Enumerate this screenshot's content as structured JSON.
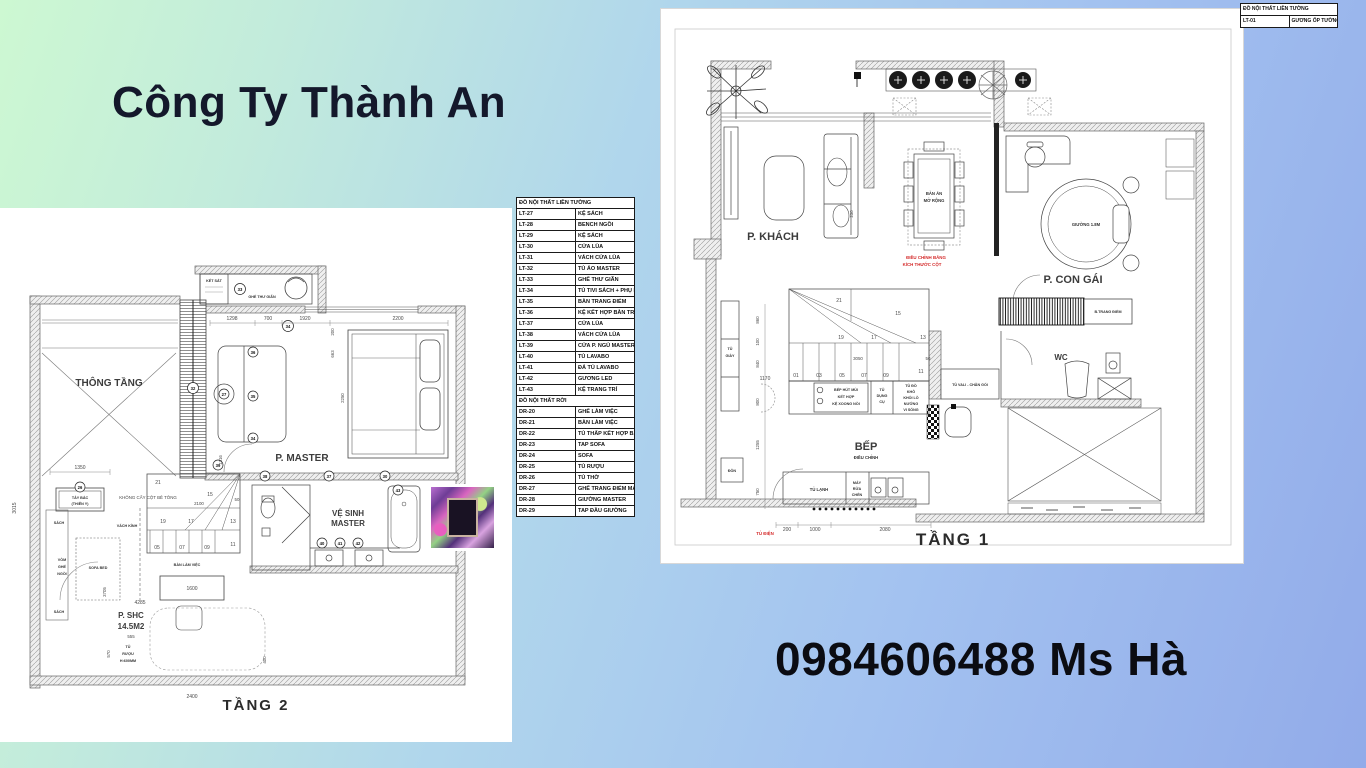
{
  "header": {
    "company": "Công Ty Thành An"
  },
  "footer": {
    "phone": "0984606488 Ms Hà"
  },
  "legend_top": {
    "header": "ĐỒ NỘI THẤT LIỀN TƯỜNG",
    "item": {
      "code": "LT-01",
      "label": "GƯƠNG ỐP TƯỜNG"
    }
  },
  "legend_main": {
    "section1_header": "ĐỒ NỘI THẤT LIỀN TƯỜNG",
    "items1": [
      {
        "code": "LT-27",
        "label": "KỆ SÁCH"
      },
      {
        "code": "LT-28",
        "label": "BENCH NGỒI"
      },
      {
        "code": "LT-29",
        "label": "KỆ SÁCH"
      },
      {
        "code": "LT-30",
        "label": "CỬA LÙA"
      },
      {
        "code": "LT-31",
        "label": "VÁCH CỬA LÙA"
      },
      {
        "code": "LT-32",
        "label": "TỦ ÁO MASTER"
      },
      {
        "code": "LT-33",
        "label": "GHẾ THƯ GIÃN"
      },
      {
        "code": "LT-34",
        "label": "TỦ TIVI SÁCH + PHỤ KIỆN"
      },
      {
        "code": "LT-35",
        "label": "BÀN TRANG ĐIỂM"
      },
      {
        "code": "LT-36",
        "label": "KỆ KẾT HỢP BÀN TRANG ĐIỂM"
      },
      {
        "code": "LT-37",
        "label": "CỬA LÙA"
      },
      {
        "code": "LT-38",
        "label": "VÁCH CỬA LÙA"
      },
      {
        "code": "LT-39",
        "label": "CỬA P. NGỦ MASTER"
      },
      {
        "code": "LT-40",
        "label": "TỦ LAVABO"
      },
      {
        "code": "LT-41",
        "label": "ĐÁ TỦ LAVABO"
      },
      {
        "code": "LT-42",
        "label": "GƯƠNG LED"
      },
      {
        "code": "LT-43",
        "label": "KỆ TRANG TRÍ"
      }
    ],
    "section2_header": "ĐỒ NỘI THẤT RỜI",
    "items2": [
      {
        "code": "DR-20",
        "label": "GHẾ LÀM VIỆC"
      },
      {
        "code": "DR-21",
        "label": "BÀN LÀM VIỆC"
      },
      {
        "code": "DR-22",
        "label": "TỦ THẤP KẾT HỢP BÀN LÀM VIỆC"
      },
      {
        "code": "DR-23",
        "label": "TAP SOFA"
      },
      {
        "code": "DR-24",
        "label": "SOFA"
      },
      {
        "code": "DR-25",
        "label": "TỦ RƯỢU"
      },
      {
        "code": "DR-26",
        "label": "TỦ THỜ"
      },
      {
        "code": "DR-27",
        "label": "GHẾ TRANG ĐIỂM MASTER"
      },
      {
        "code": "DR-28",
        "label": "GIƯỜNG MASTER"
      },
      {
        "code": "DR-29",
        "label": "TAP ĐẦU GIƯỜNG"
      }
    ]
  },
  "floor2": {
    "title": "TẦNG 2",
    "labels": {
      "thong_tang": "THÔNG TẦNG",
      "p_master": "P. MASTER",
      "ve_sinh_1": "VỆ SINH",
      "ve_sinh_2": "MASTER",
      "ket_sat": "KÉT SẮT",
      "ghe_thu_gian": "GHẾ THƯ GIÃN",
      "tay_bac_1": "TÂY BẮC",
      "tay_bac_2": "(THIÊN Y)",
      "khong_cay": "KHÔNG CẤY CỘT BÊ TÔNG",
      "vach_kinh": "VÁCH KÍNH",
      "sach_a": "SÁCH",
      "vom_1": "VÒM",
      "vom_2": "GHẾ",
      "vom_3": "NGỒI",
      "sofa_bed": "SOFA BED",
      "sach_b": "SÁCH",
      "ban_lam_viec": "BÀN LÀM VIỆC",
      "p_shc": "P. SHC",
      "p_shc_area": "14.5M2",
      "tu_ruou_1": "TỦ",
      "tu_ruou_2": "RƯỢU",
      "tu_ruou_3": "H:600MM"
    },
    "dims": {
      "d3015": "3015",
      "d1350": "1350",
      "d1298": "1298",
      "d700": "700",
      "d1920": "1920",
      "d2200": "2200",
      "d200": "200",
      "d663": "663",
      "d2250": "2250",
      "d1316": "1316",
      "d2100": "2100",
      "d50": "50",
      "d3705": "3705",
      "d1600": "1600",
      "d4285": "4285",
      "d555": "555",
      "d570": "570",
      "d2400": "2400",
      "d400": "400"
    },
    "stairs": [
      "21",
      "15",
      "19",
      "17",
      "13",
      "05",
      "07",
      "09",
      "11"
    ],
    "tags": [
      "33",
      "34",
      "32",
      "26",
      "39",
      "38",
      "37",
      "30",
      "36",
      "27",
      "35",
      "34",
      "40",
      "41",
      "42",
      "43"
    ]
  },
  "floor1": {
    "title": "TẦNG 1",
    "labels": {
      "p_khach": "P. KHÁCH",
      "ban_an_1": "BÀN ĂN",
      "ban_an_2": "MỞ RỘNG",
      "note1": "ĐIỀU CHỈNH BẰNG",
      "note2": "KÍCH THƯỚC CỘT",
      "p_con_gai": "P. CON GÁI",
      "giuong": "GIƯỜNG 1.8M",
      "trang_diem": "B.TRANG ĐIỂM",
      "wc": "WC",
      "tu_vali": "TỦ VALI - CHĂN GỐI",
      "tu_giay_1": "TỦ",
      "tu_giay_2": "GIÀY",
      "don": "ĐÔN",
      "hood_1": "BẾP HÚT MÙI",
      "hood_2": "KẾT HỢP",
      "hood_3": "KỆ XOONG NỒI",
      "dungcu_1": "TỦ",
      "dungcu_2": "DỤNG",
      "dungcu_3": "CỤ",
      "kho_1": "TỦ ĐỒ",
      "kho_2": "KHÔ",
      "kho_3": "KHỐI LÒ",
      "kho_4": "NƯỚNG",
      "kho_5": "VI SÓNG",
      "bep": "BẾP",
      "bep_sub": "ĐIỀU CHỈNH",
      "tu_lanh": "TỦ LẠNH",
      "rua_1": "MÁY",
      "rua_2": "RỬA",
      "rua_3": "CHÉN",
      "tu_dien": "TỦ ĐIỆN"
    },
    "dims": {
      "d230": "230",
      "d3050": "3050",
      "d50": "50",
      "d1170": "1170",
      "d860": "860",
      "d100": "100",
      "d840": "840",
      "d800": "800",
      "d1255": "1255",
      "d750": "750",
      "d200": "200",
      "d1000": "1000",
      "d2080": "2080"
    },
    "stairs": [
      "01",
      "03",
      "05",
      "07",
      "09",
      "11",
      "13",
      "15",
      "17",
      "19",
      "21"
    ]
  }
}
